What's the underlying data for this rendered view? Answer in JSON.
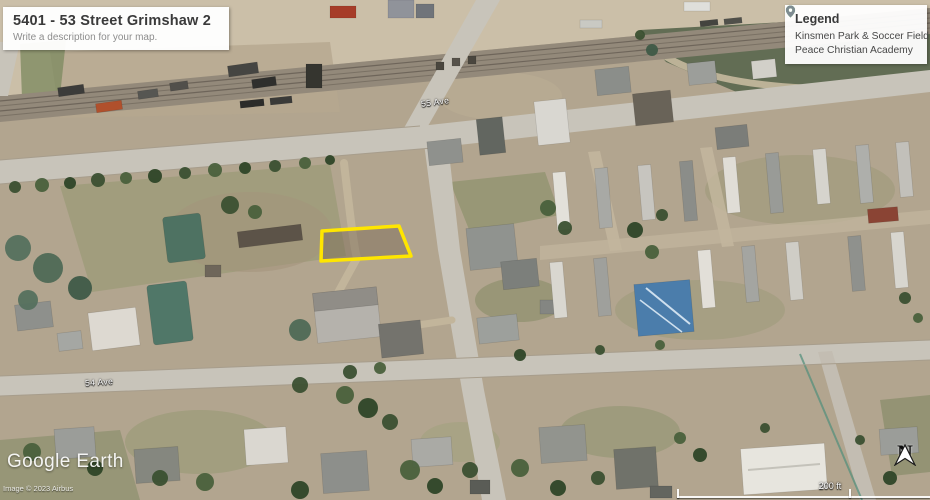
{
  "map_card": {
    "title": "5401 - 53 Street Grimshaw 2",
    "subtitle": "Write a description for your map."
  },
  "legend": {
    "title": "Legend",
    "items": [
      {
        "label": "Kinsmen Park & Soccer Field",
        "pin_color": "#2fa12e"
      },
      {
        "label": "Peace Christian Academy",
        "pin_color": "#7f8b92"
      }
    ]
  },
  "street_labels": {
    "upper": "55 Ave",
    "lower": "54 Ave"
  },
  "parcel": {
    "outline_color": "#ffe600"
  },
  "watermark": {
    "logo_text": "Google Earth",
    "copyright": "Image © 2023 Airbus"
  },
  "compass": {
    "label": "N"
  },
  "scale": {
    "label": "200 ft"
  }
}
